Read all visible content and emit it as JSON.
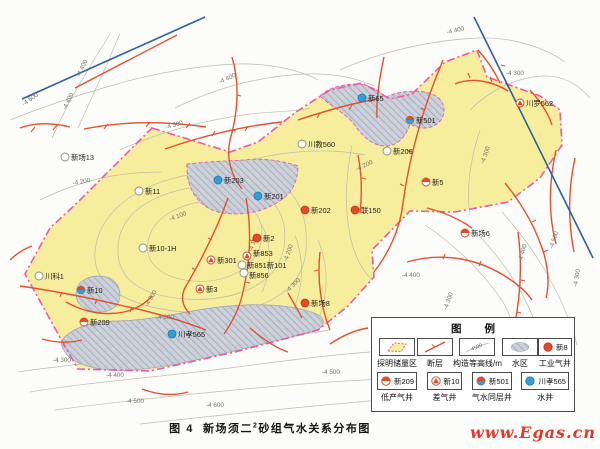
{
  "page": {
    "caption_fig": "图 4",
    "caption_pre": "新场须二",
    "caption_sup": "2",
    "caption_post": "砂组气水关系分布图",
    "watermark": "www.Egas.cn"
  },
  "legend": {
    "title": "图 例",
    "row1": [
      {
        "label": "探明储量区",
        "sym": "reserve"
      },
      {
        "label": "断层",
        "sym": "fault"
      },
      {
        "label": "构造等高线/m",
        "sym": "contour",
        "sym_text": "4500"
      },
      {
        "label": "水区",
        "sym": "waterarea"
      },
      {
        "label": "工业气井",
        "sym": "industrial",
        "well": "新8"
      }
    ],
    "row2": [
      {
        "label": "低产气井",
        "sym": "low",
        "well": "新209"
      },
      {
        "label": "差气井",
        "sym": "poor",
        "well": "新10"
      },
      {
        "label": "气水同层井",
        "sym": "gaswater",
        "well": "新501"
      },
      {
        "label": "水井",
        "sym": "water",
        "well": "川孝565"
      }
    ]
  },
  "map": {
    "colors": {
      "reserve_fill": "#f6ee9d",
      "reserve_boundary": "#ec58a8",
      "fault": "#e2512e",
      "contour": "#bcbcae",
      "water_boundary_line": "#2e5f9e",
      "well_red": "#e64b28",
      "well_blue": "#2f9fd6"
    },
    "wells": [
      {
        "x": 65,
        "y": 157,
        "type": "plain",
        "label": "新场13"
      },
      {
        "x": 139,
        "y": 191,
        "type": "plain",
        "label": "新11"
      },
      {
        "x": 218,
        "y": 180,
        "type": "water",
        "label": "新203"
      },
      {
        "x": 258,
        "y": 196,
        "type": "water",
        "label": "新201"
      },
      {
        "x": 362,
        "y": 98,
        "type": "water",
        "label": "新65"
      },
      {
        "x": 410,
        "y": 120,
        "type": "gaswater",
        "label": "新501"
      },
      {
        "x": 520,
        "y": 103,
        "type": "poor",
        "label": "川罗562"
      },
      {
        "x": 302,
        "y": 144,
        "type": "plain",
        "label": "川教560"
      },
      {
        "x": 387,
        "y": 151,
        "type": "plain",
        "label": "新206"
      },
      {
        "x": 305,
        "y": 210,
        "type": "industrial",
        "label": "新202"
      },
      {
        "x": 355,
        "y": 210,
        "type": "industrial",
        "label": "联150"
      },
      {
        "x": 426,
        "y": 182,
        "type": "low",
        "label": "新5"
      },
      {
        "x": 465,
        "y": 233,
        "type": "low",
        "label": "新场6"
      },
      {
        "x": 257,
        "y": 238,
        "type": "industrial",
        "label": "新2"
      },
      {
        "x": 211,
        "y": 260,
        "type": "poor",
        "label": "新301"
      },
      {
        "x": 247,
        "y": 256,
        "type": "poor",
        "label": "新853",
        "dy": 0
      },
      {
        "x": 242,
        "y": 265,
        "type": "plain",
        "label": "新851新101",
        "dx": 5
      },
      {
        "x": 244,
        "y": 273,
        "type": "plain",
        "label": "新856",
        "dx": 5,
        "dy": 5
      },
      {
        "x": 200,
        "y": 289,
        "type": "poor",
        "label": "新3"
      },
      {
        "x": 143,
        "y": 248,
        "type": "plain",
        "label": "新10-1H"
      },
      {
        "x": 39,
        "y": 276,
        "type": "plain",
        "label": "川科1"
      },
      {
        "x": 81,
        "y": 290,
        "type": "gaswater",
        "label": "新10"
      },
      {
        "x": 84,
        "y": 322,
        "type": "low",
        "label": "新209"
      },
      {
        "x": 172,
        "y": 334,
        "type": "water",
        "label": "川孝565"
      },
      {
        "x": 305,
        "y": 303,
        "type": "industrial",
        "label": "新场8"
      }
    ],
    "contour_labels": [
      {
        "t": "-4 500",
        "x": 24,
        "y": 106,
        "r": -35
      },
      {
        "t": "-4 400",
        "x": 66,
        "y": 110,
        "r": -65
      },
      {
        "t": "-4 400",
        "x": 80,
        "y": 77,
        "r": -65
      },
      {
        "t": "-4 300",
        "x": 166,
        "y": 129,
        "r": -15
      },
      {
        "t": "-4 400",
        "x": 220,
        "y": 84,
        "r": -25
      },
      {
        "t": "-4 400",
        "x": 447,
        "y": 34,
        "r": -12
      },
      {
        "t": "-4 300",
        "x": 506,
        "y": 75,
        "r": 0
      },
      {
        "t": "-4 200",
        "x": 73,
        "y": 185,
        "r": -10
      },
      {
        "t": "-4 100",
        "x": 170,
        "y": 221,
        "r": -20
      },
      {
        "t": "-4 100",
        "x": 252,
        "y": 252,
        "r": -70
      },
      {
        "t": "-4 200",
        "x": 287,
        "y": 262,
        "r": -70
      },
      {
        "t": "-4 300",
        "x": 288,
        "y": 293,
        "r": -45
      },
      {
        "t": "-4 200",
        "x": 357,
        "y": 171,
        "r": -25
      },
      {
        "t": "-4 300",
        "x": 484,
        "y": 164,
        "r": -70
      },
      {
        "t": "-4 200",
        "x": 156,
        "y": 319,
        "r": 0
      },
      {
        "t": "-4 300",
        "x": 53,
        "y": 362,
        "r": 0
      },
      {
        "t": "-4 300",
        "x": 148,
        "y": 307,
        "r": -60
      },
      {
        "t": "-4 400",
        "x": 106,
        "y": 377,
        "r": 0
      },
      {
        "t": "-4 500",
        "x": 126,
        "y": 403,
        "r": 0
      },
      {
        "t": "-4 600",
        "x": 206,
        "y": 407,
        "r": 0
      },
      {
        "t": "-4 500",
        "x": 322,
        "y": 374,
        "r": 0
      },
      {
        "t": "-4 400",
        "x": 402,
        "y": 277,
        "r": 0
      },
      {
        "t": "-4 300",
        "x": 447,
        "y": 310,
        "r": -70
      },
      {
        "t": "-4 400",
        "x": 522,
        "y": 262,
        "r": -75
      },
      {
        "t": "-4 500",
        "x": 553,
        "y": 249,
        "r": -72
      },
      {
        "t": "-4 300",
        "x": 577,
        "y": 287,
        "r": -80
      }
    ]
  }
}
